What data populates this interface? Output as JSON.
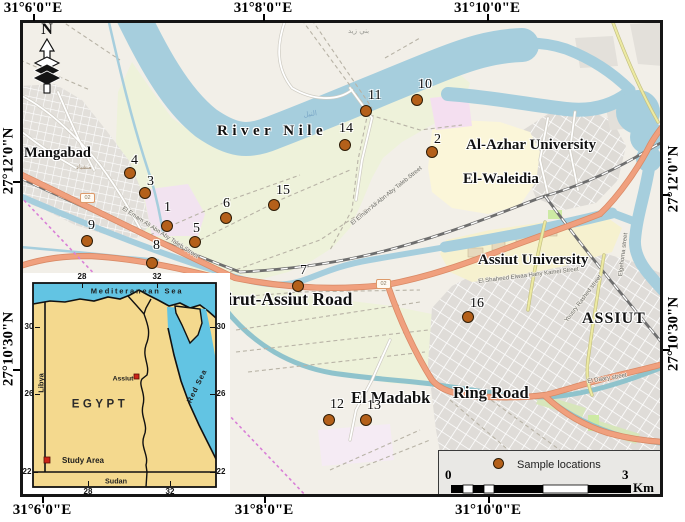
{
  "figure": {
    "width": 685,
    "height": 522
  },
  "map": {
    "north_label": "N",
    "axis": {
      "top": [
        {
          "t": "31°6'0\"E",
          "x": 33
        },
        {
          "t": "31°8'0\"E",
          "x": 263
        },
        {
          "t": "31°10'0\"E",
          "x": 487
        }
      ],
      "bottom": [
        {
          "t": "31°6'0\"E",
          "x": 42
        },
        {
          "t": "31°8'0\"E",
          "x": 264
        },
        {
          "t": "31°10'0\"E",
          "x": 488
        }
      ],
      "left": [
        {
          "t": "27°12'0\"N",
          "y": 161
        },
        {
          "t": "27°10'30\"N",
          "y": 349
        }
      ],
      "right": [
        {
          "t": "27°12'0\"N",
          "y": 179
        },
        {
          "t": "27°10'30\"N",
          "y": 334
        }
      ]
    },
    "places": [
      {
        "t": "Mangabad",
        "x": 24,
        "y": 146,
        "fs": 14.5
      },
      {
        "t": "River Nile",
        "x": 217,
        "y": 124,
        "fs": 15,
        "ls": 4.5
      },
      {
        "t": "Al-Azhar University",
        "x": 466,
        "y": 138,
        "fs": 15
      },
      {
        "t": "El-Waleidia",
        "x": 463,
        "y": 172,
        "fs": 15
      },
      {
        "t": "Assiut University",
        "x": 478,
        "y": 253,
        "fs": 15
      },
      {
        "t": "ASSIUT",
        "x": 582,
        "y": 311,
        "fs": 16,
        "ls": 1
      },
      {
        "t": "Dairut-Assiut Road",
        "x": 206,
        "y": 291,
        "fs": 17.5
      },
      {
        "t": "El Madabk",
        "x": 351,
        "y": 390,
        "fs": 16.5
      },
      {
        "t": "Ring Road",
        "x": 453,
        "y": 385,
        "fs": 16.5
      }
    ],
    "streets": [
      {
        "t": "El Emam Ali Abn Aby Taleb Street",
        "x": 124,
        "y": 206,
        "rot": 33
      },
      {
        "t": "El Emam Ali Abn Aby Taleb Street",
        "x": 350,
        "y": 222,
        "rot": -39
      },
      {
        "t": "El Shaheed Elwaa Hany Kamel Street",
        "x": 478,
        "y": 279,
        "rot": -7
      },
      {
        "t": "Elgehoma street",
        "x": 618,
        "y": 276,
        "rot": -83
      },
      {
        "t": "Yousry Rashed street",
        "x": 564,
        "y": 320,
        "rot": -53
      },
      {
        "t": "El Daary street",
        "x": 587,
        "y": 379,
        "rot": -9
      }
    ],
    "arabic": [
      {
        "t": "بني زيد",
        "x": 348,
        "y": 28,
        "fs": 7,
        "color": "#9a9a94"
      },
      {
        "t": "النيل",
        "x": 303,
        "y": 112,
        "fs": 7,
        "color": "#7aa7c7",
        "rot": -8
      },
      {
        "t": "منقباد",
        "x": 76,
        "y": 164,
        "fs": 6.5,
        "color": "#a5947f"
      }
    ],
    "shields": [
      {
        "t": "02",
        "x": 80,
        "y": 193
      },
      {
        "t": "02",
        "x": 376,
        "y": 279
      }
    ],
    "points": [
      {
        "n": "1",
        "x": 167,
        "y": 226,
        "lx": 164,
        "ly": 201
      },
      {
        "n": "2",
        "x": 432,
        "y": 152,
        "lx": 434,
        "ly": 133
      },
      {
        "n": "3",
        "x": 145,
        "y": 193,
        "lx": 147,
        "ly": 175
      },
      {
        "n": "4",
        "x": 130,
        "y": 173,
        "lx": 131,
        "ly": 154
      },
      {
        "n": "5",
        "x": 195,
        "y": 242,
        "lx": 193,
        "ly": 222
      },
      {
        "n": "6",
        "x": 226,
        "y": 218,
        "lx": 223,
        "ly": 197
      },
      {
        "n": "7",
        "x": 298,
        "y": 286,
        "lx": 300,
        "ly": 264
      },
      {
        "n": "8",
        "x": 152,
        "y": 263,
        "lx": 153,
        "ly": 239
      },
      {
        "n": "9",
        "x": 87,
        "y": 241,
        "lx": 88,
        "ly": 219
      },
      {
        "n": "10",
        "x": 417,
        "y": 100,
        "lx": 418,
        "ly": 78
      },
      {
        "n": "11",
        "x": 366,
        "y": 111,
        "lx": 368,
        "ly": 89
      },
      {
        "n": "12",
        "x": 329,
        "y": 420,
        "lx": 330,
        "ly": 398
      },
      {
        "n": "13",
        "x": 366,
        "y": 420,
        "lx": 367,
        "ly": 399
      },
      {
        "n": "14",
        "x": 345,
        "y": 145,
        "lx": 339,
        "ly": 122
      },
      {
        "n": "15",
        "x": 274,
        "y": 205,
        "lx": 276,
        "ly": 184
      },
      {
        "n": "16",
        "x": 468,
        "y": 317,
        "lx": 470,
        "ly": 297
      }
    ]
  },
  "inset": {
    "labels": [
      {
        "t": "Mediteranean Sea",
        "x": 137,
        "y": 291,
        "fs": 7.5,
        "ls": 1.8
      },
      {
        "t": "EGYPT",
        "x": 100,
        "y": 405,
        "fs": 11.5,
        "ls": 3.5,
        "color": "#2b2b2b"
      },
      {
        "t": "Libya",
        "x": 41,
        "y": 383,
        "fs": 7.5,
        "rot": -90
      },
      {
        "t": "Red Sea",
        "x": 197,
        "y": 386,
        "fs": 7.5,
        "rot": -64,
        "ls": 1
      },
      {
        "t": "Assiut",
        "x": 123,
        "y": 380,
        "fs": 6.8
      },
      {
        "t": "Study Area",
        "x": 83,
        "y": 461,
        "fs": 8
      },
      {
        "t": "Sudan",
        "x": 116,
        "y": 481,
        "fs": 7.2
      }
    ],
    "ticks": [
      {
        "t": "28",
        "x": 82,
        "y": 277,
        "side": "top"
      },
      {
        "t": "32",
        "x": 157,
        "y": 277,
        "side": "top"
      },
      {
        "t": "28",
        "x": 88,
        "y": 492,
        "side": "bottom"
      },
      {
        "t": "32",
        "x": 170,
        "y": 492,
        "side": "bottom"
      },
      {
        "t": "30",
        "x": 29,
        "y": 327,
        "side": "left"
      },
      {
        "t": "26",
        "x": 29,
        "y": 394,
        "side": "left"
      },
      {
        "t": "22",
        "x": 27,
        "y": 472,
        "side": "left"
      },
      {
        "t": "30",
        "x": 221,
        "y": 327,
        "side": "right"
      },
      {
        "t": "26",
        "x": 221,
        "y": 394,
        "side": "right"
      },
      {
        "t": "22",
        "x": 221,
        "y": 472,
        "side": "right"
      }
    ]
  },
  "legend": {
    "title": "Sample locations",
    "zero": "0",
    "max": "3",
    "unit": "Km"
  },
  "colors": {
    "water": "#a6cedd",
    "farmland": "#eef2da",
    "urban": "#dfdcd8",
    "campus_yellow": "#f6f1cf",
    "pink_area": "#f2e3f0",
    "trunk_road": "#f0a07e",
    "secondary_road": "#edeaa2",
    "railway": "#6e6e6e",
    "boundary": "#d97fd7",
    "sample_dot": "#b4601a",
    "inset_sea": "#62c4e3",
    "inset_land": "#f4d98e",
    "marker_red": "#cc2418"
  }
}
